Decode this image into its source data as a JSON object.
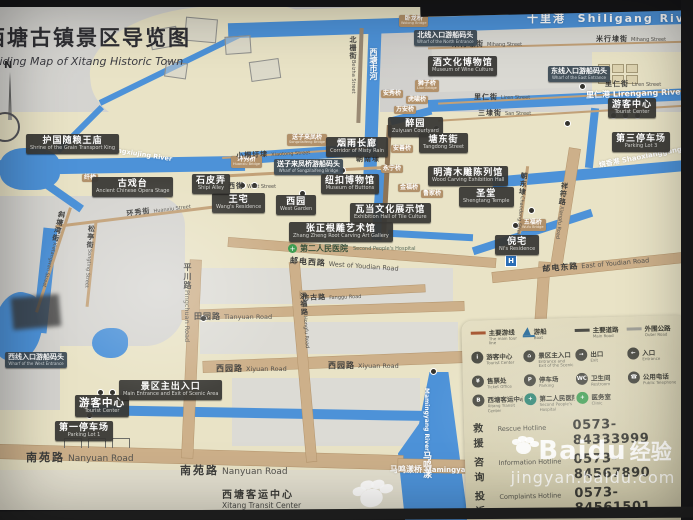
{
  "title": {
    "zh": "西塘古镇景区导览图",
    "en": "Guiding Map of Xitang Historic Town"
  },
  "compass": {
    "n": "N"
  },
  "colors": {
    "water": "#4d92d8",
    "land": "#e9e3c6",
    "road": "#cdb08a",
    "label_dark": "#383734",
    "legend_bg": "#d9d3b6",
    "tour_line": "#a85a36"
  },
  "places": [
    {
      "zh": "护国随粮王庙",
      "en": "Shrine of the Grain Transport King"
    },
    {
      "zh": "醉园",
      "en": "Zuiyuan Courtyard"
    },
    {
      "zh": "烟雨长廊",
      "en": "Corridor of Misty Rain"
    },
    {
      "zh": "塘东街",
      "en": "Tangdong Street"
    },
    {
      "zh": "酒文化博物馆",
      "en": "Museum of Wine Culture"
    },
    {
      "zh": "纽扣博物馆",
      "en": "Museum of Buttons"
    },
    {
      "zh": "瓦当文化展示馆",
      "en": "Exhibition Hall of Tile Culture"
    },
    {
      "zh": "张正根雕艺术馆",
      "en": "Zhang Zheng Root Carving Art Gallery"
    },
    {
      "zh": "王宅",
      "en": "Wang's Residence"
    },
    {
      "zh": "西园",
      "en": "West Garden"
    },
    {
      "zh": "石皮弄",
      "en": "Shipi Alley"
    },
    {
      "zh": "古戏台",
      "en": "Ancient Chinese Opera Stage"
    },
    {
      "zh": "圣堂",
      "en": "Shengtang Temple"
    },
    {
      "zh": "明清木雕陈列馆",
      "en": "Wood Carving Exhibition Hall"
    },
    {
      "zh": "倪宅",
      "en": "Ni's Residence"
    },
    {
      "zh": "游客中心",
      "en": "Tourist Center"
    },
    {
      "zh": "第三停车场",
      "en": "Parking Lot 3"
    },
    {
      "zh": "游客中心",
      "en": "Tourist Center"
    },
    {
      "zh": "景区主出入口",
      "en": "Main Entrance and Exit of Scenic Area"
    },
    {
      "zh": "第一停车场",
      "en": "Parking Lot 1"
    },
    {
      "zh": "第二人民医院",
      "en": "Second People's Hospital"
    },
    {
      "zh": "西塘客运中心",
      "en": "Xitang Transit Center"
    }
  ],
  "wharfs": [
    {
      "zh": "北线入口游船码头",
      "en": "Wharf of the North Entrance"
    },
    {
      "zh": "东线入口游船码头",
      "en": "Wharf of the East Entrance"
    },
    {
      "zh": "西线入口游船码头",
      "en": "Wharf of the West Entrance"
    },
    {
      "zh": "送子来凤桥游船码头",
      "en": "Wharf of Songzilaifeng Bridge"
    }
  ],
  "streets": [
    {
      "zh": "米行埭街",
      "en": "Mihang Street"
    },
    {
      "zh": "米行埭街",
      "en": "Mihang Street"
    },
    {
      "zh": "里仁街",
      "en": "Liren Street"
    },
    {
      "zh": "里仁街",
      "en": "Liren Street"
    },
    {
      "zh": "三埭街",
      "en": "San Street"
    },
    {
      "zh": "北栅街",
      "en": "Beizha Street"
    },
    {
      "zh": "朝南埭",
      "en": "Chaonandai"
    },
    {
      "zh": "小桐圩埭",
      "en": "Xiaotong Street"
    },
    {
      "zh": "西街",
      "en": "West Street"
    },
    {
      "zh": "环秀街",
      "en": "Huanxiu Street"
    },
    {
      "zh": "斜塘湾街",
      "en": "Xietangwan Street"
    },
    {
      "zh": "松亭街",
      "en": "Songting Street"
    },
    {
      "zh": "平川路",
      "en": "Pingchuan Road"
    },
    {
      "zh": "田园路",
      "en": "Tianyuan Road"
    },
    {
      "zh": "西园路",
      "en": "Xiyuan Road"
    },
    {
      "zh": "西园路",
      "en": "Xiyuan Road"
    },
    {
      "zh": "南苑路",
      "en": "Nanyuan Road"
    },
    {
      "zh": "南苑路",
      "en": "Nanyuan Road"
    },
    {
      "zh": "邮电西路",
      "en": "West of Youdian Road"
    },
    {
      "zh": "邮电东路",
      "en": "East of Youdian Road"
    },
    {
      "zh": "仿古路",
      "en": "Fanggu Road"
    },
    {
      "zh": "洪福路",
      "en": "Hongfu Road"
    },
    {
      "zh": "祥符路",
      "en": "Xiangfu Road"
    },
    {
      "zh": "朝东埭",
      "en": "Chaodong Street"
    },
    {
      "zh": "马鸣漾桥",
      "en": "Mamingyang Bridge"
    }
  ],
  "rivers": [
    {
      "zh": "十里港",
      "en": "Shiligang River"
    },
    {
      "zh": "里仁港",
      "en": "Lirengang River"
    },
    {
      "zh": "烧香港",
      "en": "Shaoxianggang River"
    },
    {
      "zh": "杨秀泾",
      "en": "Yangxiujing River"
    },
    {
      "zh": "西塘市河",
      "en": ""
    },
    {
      "zh": "马鸣漾",
      "en": "Mamingyang River"
    }
  ],
  "bridges": [
    {
      "zh": "卧龙桥",
      "en": "Wolong Bridge"
    },
    {
      "zh": "狮子桥",
      "en": "Lion Bridge"
    },
    {
      "zh": "安秀桥",
      "en": ""
    },
    {
      "zh": "虎啸桥",
      "en": ""
    },
    {
      "zh": "万安桥",
      "en": ""
    },
    {
      "zh": "环秀桥",
      "en": "Huanxiu Bridge"
    },
    {
      "zh": "送子来凤桥",
      "en": "Songzilaifeng Bridge"
    },
    {
      "zh": "五福桥",
      "en": "Wufu Bridge"
    },
    {
      "zh": "安善桥",
      "en": ""
    },
    {
      "zh": "永宁桥",
      "en": ""
    },
    {
      "zh": "金福桥",
      "en": ""
    },
    {
      "zh": "鲁家桥",
      "en": ""
    },
    {
      "zh": "纤桥",
      "en": ""
    }
  ],
  "legend": {
    "items": [
      {
        "glyph": "",
        "zh": "主要游线",
        "en": "The main tour line"
      },
      {
        "glyph": "",
        "zh": "游船",
        "en": "Boat"
      },
      {
        "glyph": "",
        "zh": "主要道路",
        "en": "Main Road"
      },
      {
        "glyph": "",
        "zh": "外围公路",
        "en": "Outer Road"
      },
      {
        "glyph": "i",
        "zh": "游客中心",
        "en": "Tourist Center"
      },
      {
        "glyph": "⌂",
        "zh": "景区主入口",
        "en": "Entrance and Exit of the Scenic Area"
      },
      {
        "glyph": "→",
        "zh": "出口",
        "en": "Exit"
      },
      {
        "glyph": "←",
        "zh": "入口",
        "en": "Entrance"
      },
      {
        "glyph": "¥",
        "zh": "售票处",
        "en": "Ticket Office"
      },
      {
        "glyph": "P",
        "zh": "停车场",
        "en": "Parking"
      },
      {
        "glyph": "WC",
        "zh": "卫生间",
        "en": "Restroom"
      },
      {
        "glyph": "☎",
        "zh": "公用电话",
        "en": "Public Telephone"
      },
      {
        "glyph": "B",
        "zh": "西塘客运中心",
        "en": "Xitang Transit Center"
      },
      {
        "glyph": "+",
        "zh": "第二人民医院",
        "en": "Second People's Hospital"
      },
      {
        "glyph": "+",
        "zh": "医务室",
        "en": "Clinic"
      }
    ]
  },
  "hotlines": [
    {
      "zh": "救援",
      "en": "Rescue Hotline",
      "number": "0573-84333999"
    },
    {
      "zh": "咨询",
      "en": "Information Hotline",
      "number": "0573-84567890"
    },
    {
      "zh": "投诉",
      "en": "Complaints Hotline",
      "number": "0573-84561501"
    }
  ],
  "poi": {
    "hospital": "H"
  },
  "watermark": {
    "brand_en": "Baidu",
    "brand_zh": "经验",
    "url": "jingyan.baidu.com"
  }
}
